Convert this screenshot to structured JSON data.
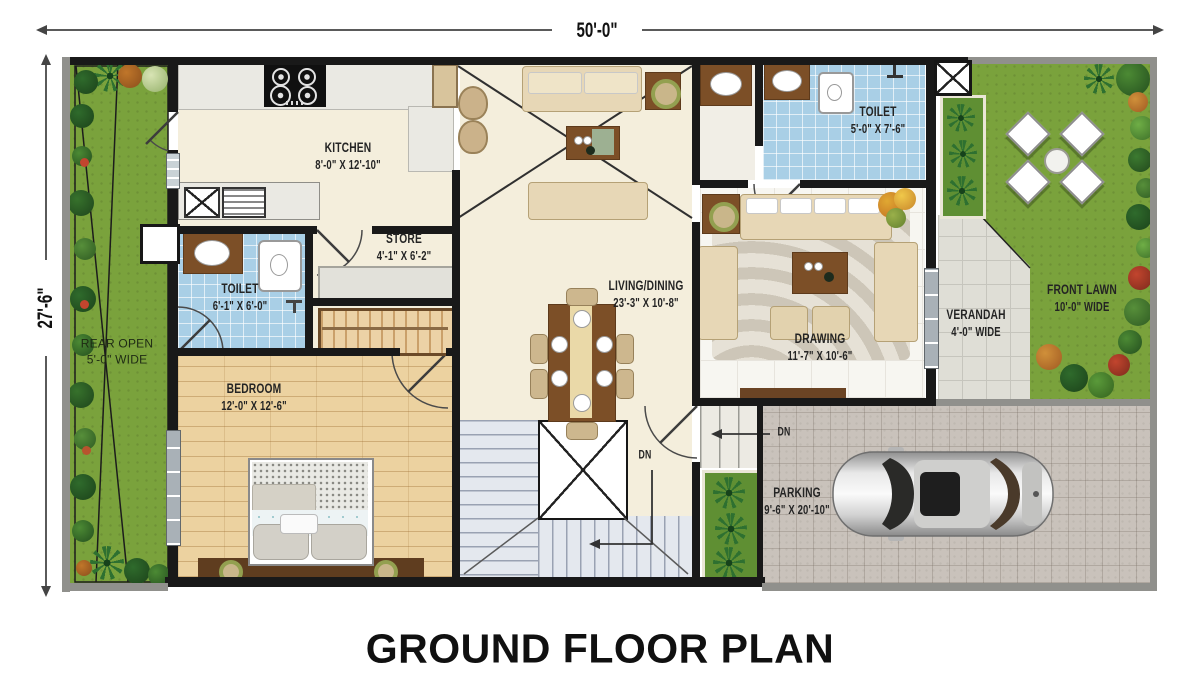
{
  "title": "GROUND FLOOR PLAN",
  "dimensions": {
    "overall_width": "50'-0\"",
    "overall_depth": "27'-6\""
  },
  "rooms": {
    "kitchen": {
      "name": "KITCHEN",
      "size": "8'-0\" X 12'-10\""
    },
    "store": {
      "name": "STORE",
      "size": "4'-1\" X 6'-2\""
    },
    "toilet_rear": {
      "name": "TOILET",
      "size": "6'-1\" X 6'-0\""
    },
    "bedroom": {
      "name": "BEDROOM",
      "size": "12'-0\" X 12'-6\""
    },
    "living_dining": {
      "name": "LIVING/DINING",
      "size": "23'-3\" X 10'-8\""
    },
    "toilet_front": {
      "name": "TOILET",
      "size": "5'-0\" X 7'-6\""
    },
    "drawing": {
      "name": "DRAWING",
      "size": "11'-7\" X 10'-6\""
    },
    "verandah": {
      "name": "VERANDAH",
      "size": "4'-0\" WIDE"
    },
    "front_lawn": {
      "name": "FRONT LAWN",
      "size": "10'-0\" WIDE"
    },
    "rear_open": {
      "name": "REAR OPEN",
      "size": "5'-0\" WIDE"
    },
    "parking": {
      "name": "PARKING",
      "size": "9'-6\" X 20'-10\""
    }
  },
  "annotations": {
    "stair_down": "DN",
    "entry_down": "DN"
  },
  "colors": {
    "wall": "#191919",
    "lawn_green": "#7aa23c",
    "tile_blue": "#a9cfe6",
    "wood": "#ecd2a0",
    "paver_grey": "#c9c2bb",
    "floor_cream": "#f4eedc"
  }
}
